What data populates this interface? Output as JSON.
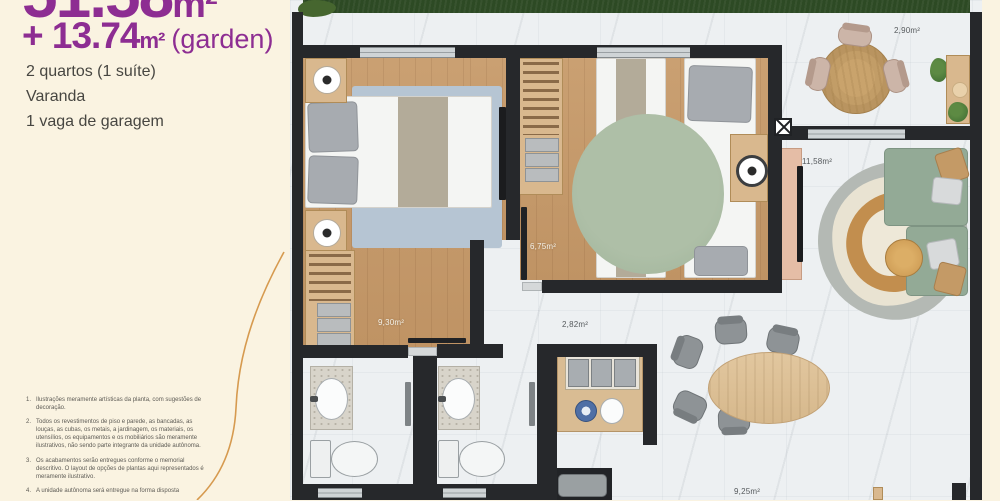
{
  "panel": {
    "area_main": {
      "value": "51.58",
      "unit": "m²"
    },
    "area_garden": {
      "prefix": "+ 13.74",
      "unit": "m²",
      "suffix": "(garden)"
    },
    "features": [
      "2 quartos (1 suíte)",
      "Varanda",
      "1 vaga de garagem"
    ],
    "footnotes": [
      {
        "num": "1.",
        "text": "Ilustrações meramente artísticas da planta, com sugestões de decoração."
      },
      {
        "num": "2.",
        "text": "Todos os revestimentos de piso e parede, as bancadas, as louças, as cubas, os metais, a jardinagem, os materiais, os utensílios, os equipamentos e os mobiliários são meramente ilustrativos, não sendo parte integrante da unidade autônoma."
      },
      {
        "num": "3.",
        "text": "Os acabamentos serão entregues conforme o memorial descritivo. O layout de opções de plantas aqui representados é meramente ilustrativo."
      },
      {
        "num": "4.",
        "text": "A unidade autônoma será entregue na forma disposta"
      }
    ]
  },
  "plan": {
    "labels": {
      "terrace": "2,90m²",
      "living": "11,58m²",
      "bedroom1": "9,30m²",
      "bedroom2": "6,75m²",
      "hall": "2,82m²",
      "dining": "9,25m²"
    }
  },
  "colors": {
    "panel_bg": "#faf3e1",
    "accent_purple": "#8d2d92",
    "text_dark": "#474641",
    "wall": "#26282b",
    "grass": "#2d4a24",
    "wood_floor": "#c59a6d",
    "sage_green": "#96ac98",
    "rug_blue": "#b6c5d3",
    "arc_orange": "#d69a4f"
  }
}
